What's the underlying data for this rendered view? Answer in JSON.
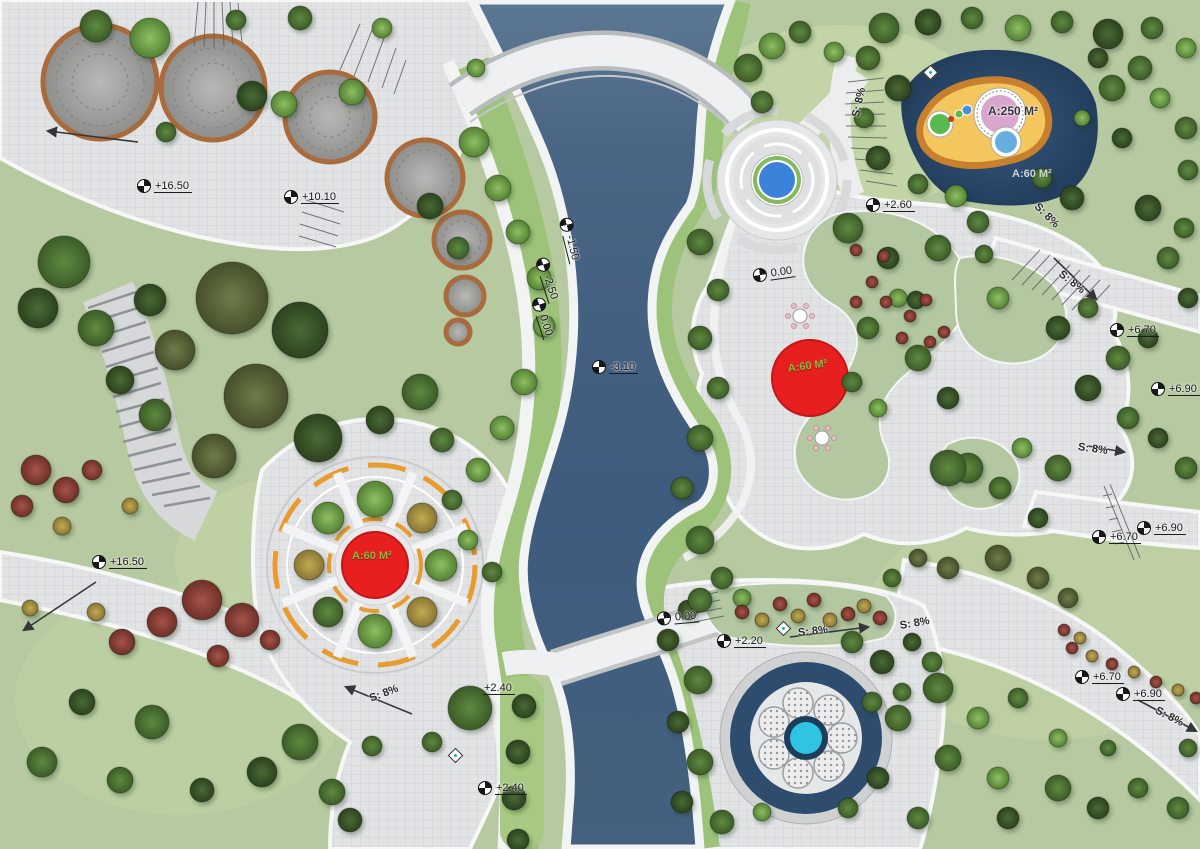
{
  "plan": {
    "kind": "landscape-park-master-plan",
    "canvas": {
      "width": 1200,
      "height": 849
    }
  },
  "colors": {
    "lawn": "#b7c9a0",
    "lawn_bright": "#9cc379",
    "pavement": "#e2e3e5",
    "pavement_line": "#c7c9cc",
    "bank_white": "#f2f3f3",
    "river_deep": "#3e5b7d",
    "river_light": "#5d7893",
    "pond_navy": "#2a4765",
    "fountain_blue": "#3b82d9",
    "fountain_cyan": "#2fc5e2",
    "pool_sand": "#f4c65e",
    "pool_rim_orange": "#c8802e",
    "pool_pink": "#d9a6ce",
    "plaza_orange": "#e89b2f",
    "feature_red": "#e81f1f",
    "tree_dark": "#3a5529",
    "tree_mid": "#4f7438",
    "tree_light": "#6fa04c",
    "tree_olive": "#5f6e3e",
    "tree_autumn_red": "#8e4a41",
    "shrub_yellow": "#b2a04a"
  },
  "annotations": {
    "spot_elevations": [
      {
        "text": "+16.50",
        "x": 143,
        "y": 186,
        "rot": 0
      },
      {
        "text": "+10.10",
        "x": 290,
        "y": 197,
        "rot": 0
      },
      {
        "text": "-1.50",
        "x": 571,
        "y": 218,
        "rot": 76
      },
      {
        "text": "-2.50",
        "x": 547,
        "y": 258,
        "rot": 72
      },
      {
        "text": "0.00",
        "x": 543,
        "y": 298,
        "rot": 72
      },
      {
        "text": "-3.10",
        "x": 598,
        "y": 367,
        "rot": 0
      },
      {
        "text": "+2.60",
        "x": 872,
        "y": 205,
        "rot": 0
      },
      {
        "text": "0.00",
        "x": 759,
        "y": 276,
        "rot": -8
      },
      {
        "text": "+6.70",
        "x": 1116,
        "y": 330,
        "rot": 0
      },
      {
        "text": "+6.90",
        "x": 1157,
        "y": 389,
        "rot": 0
      },
      {
        "text": "+6.90",
        "x": 1143,
        "y": 528,
        "rot": 0
      },
      {
        "text": "+6.70",
        "x": 1098,
        "y": 537,
        "rot": 0
      },
      {
        "text": "+6.70",
        "x": 1081,
        "y": 677,
        "rot": 0
      },
      {
        "text": "+6.90",
        "x": 1122,
        "y": 694,
        "rot": 0
      },
      {
        "text": "0.00",
        "x": 663,
        "y": 619,
        "rot": -5
      },
      {
        "text": "+2.20",
        "x": 723,
        "y": 641,
        "rot": 0
      },
      {
        "text": "+2.40",
        "x": 489,
        "y": 689,
        "rot": 0,
        "marker": false
      },
      {
        "text": "+2.40",
        "x": 484,
        "y": 788,
        "rot": 0
      },
      {
        "text": "+16.50",
        "x": 98,
        "y": 562,
        "rot": 0
      }
    ],
    "slope_labels": [
      {
        "text": "S: 8%",
        "x": 856,
        "y": 118,
        "rot": -78
      },
      {
        "text": "S: 8%",
        "x": 1036,
        "y": 206,
        "rot": 45
      },
      {
        "text": "S: 8%",
        "x": 1060,
        "y": 274,
        "rot": 38
      },
      {
        "text": "S: 8%",
        "x": 1078,
        "y": 448,
        "rot": 8
      },
      {
        "text": "S: 8%",
        "x": 798,
        "y": 634,
        "rot": -6
      },
      {
        "text": "S: 8%",
        "x": 900,
        "y": 627,
        "rot": -10
      },
      {
        "text": "S: 8%",
        "x": 1156,
        "y": 711,
        "rot": 27
      },
      {
        "text": "S: 8%",
        "x": 370,
        "y": 700,
        "rot": -21
      }
    ],
    "area_labels": [
      {
        "text": "A:250 M²",
        "x": 988,
        "y": 111,
        "rot": 0,
        "style": "dark"
      },
      {
        "text": "A:60 M²",
        "x": 1012,
        "y": 175,
        "rot": 0,
        "style": "light"
      },
      {
        "text": "A:60 M²",
        "x": 788,
        "y": 370,
        "rot": -8,
        "style": "green"
      },
      {
        "text": "A:60 M²",
        "x": 352,
        "y": 557,
        "rot": 0,
        "style": "green"
      }
    ],
    "light_fixtures": [
      {
        "x": 930,
        "y": 72
      },
      {
        "x": 783,
        "y": 628
      },
      {
        "x": 455,
        "y": 755
      }
    ]
  }
}
